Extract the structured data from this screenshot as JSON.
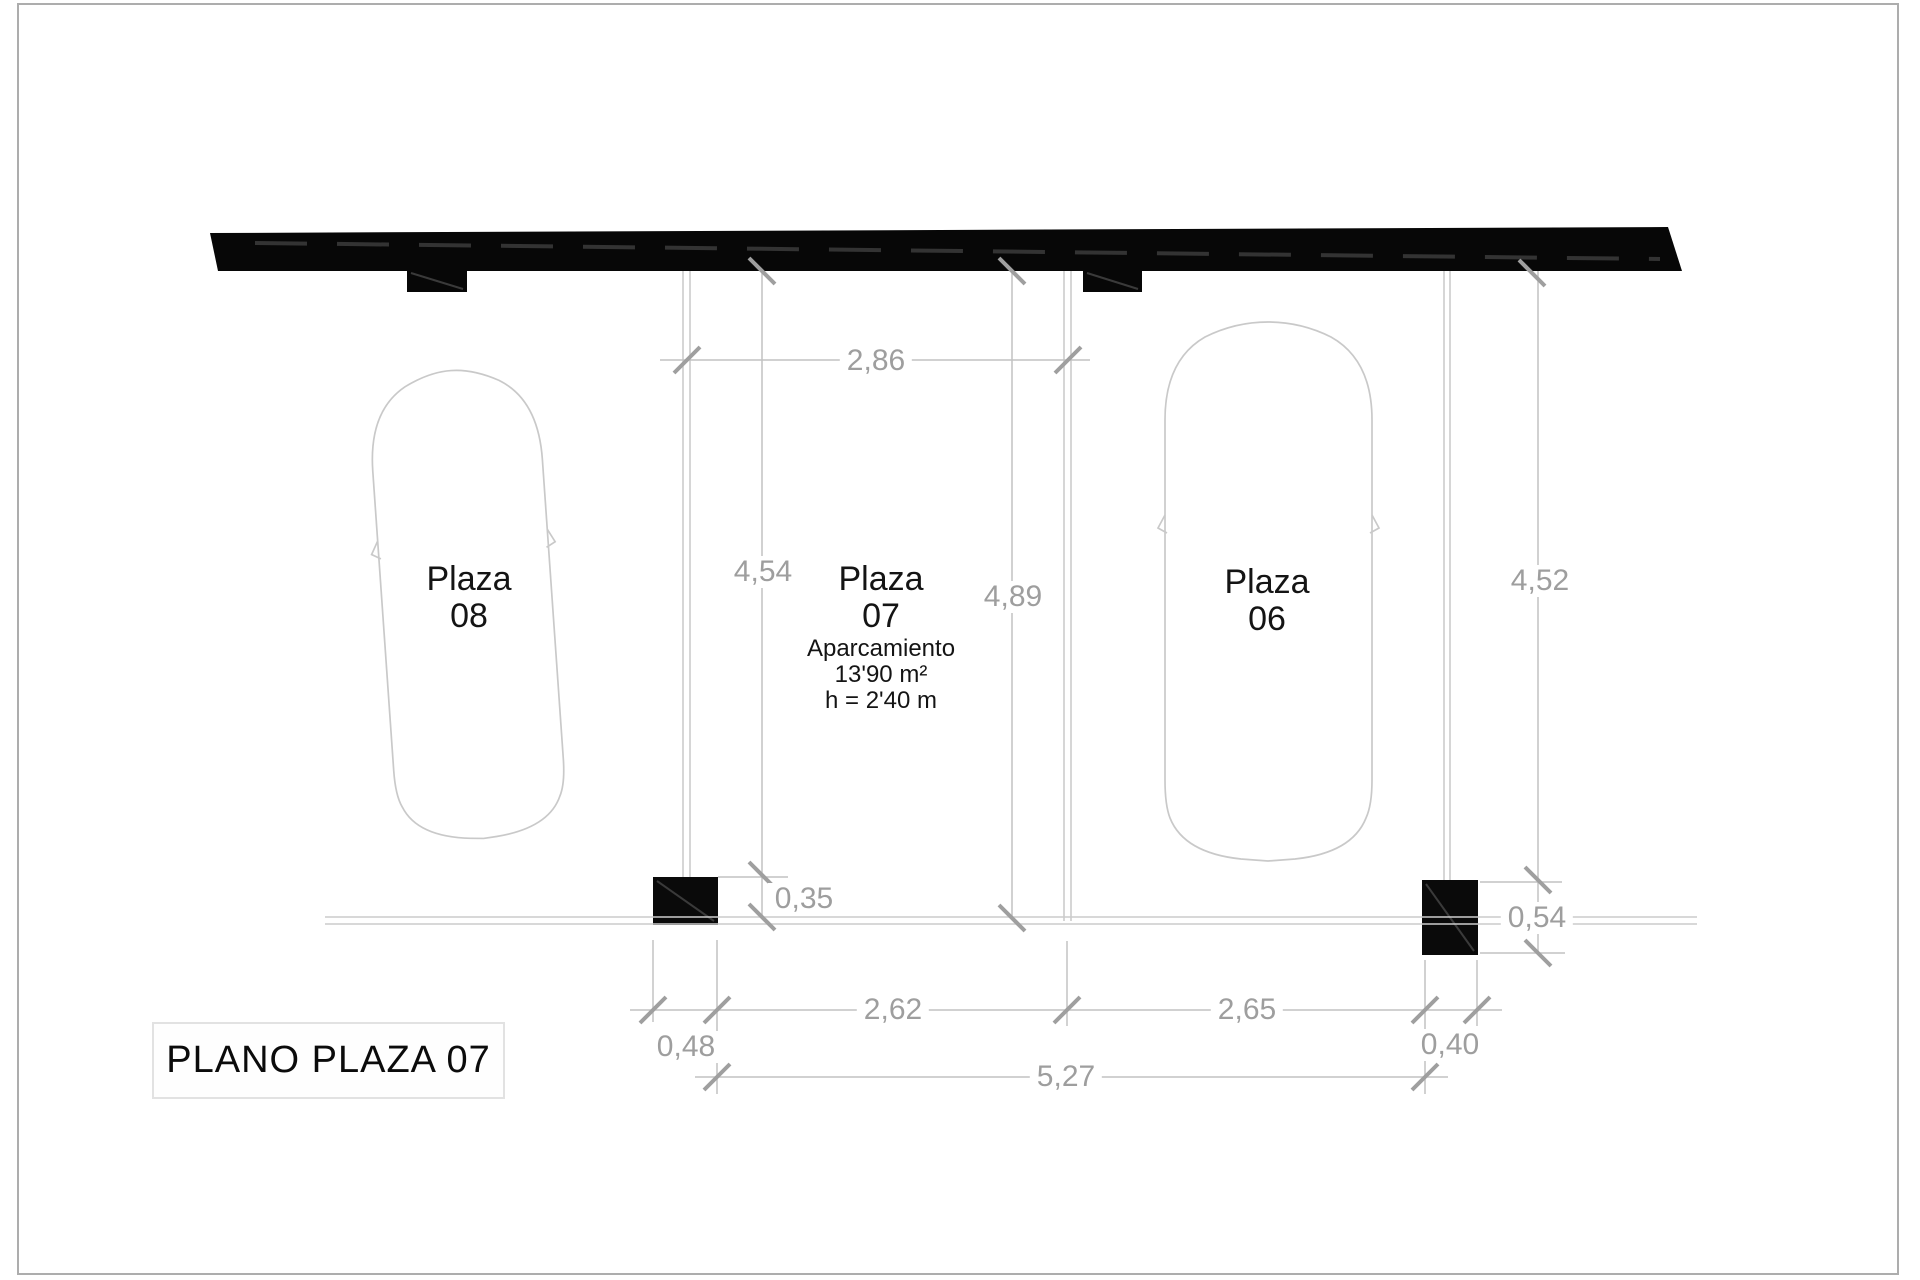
{
  "title_block": {
    "label": "PLANO PLAZA 07"
  },
  "plazas": [
    {
      "name": "Plaza",
      "number": "08"
    },
    {
      "name": "Plaza",
      "number": "07",
      "details": [
        "Aparcamiento",
        "13'90 m²",
        "h = 2'40 m"
      ]
    },
    {
      "name": "Plaza",
      "number": "06"
    }
  ],
  "dimensions": {
    "top_width": "2,86",
    "depth_left": "4,54",
    "depth_center": "4,89",
    "depth_right": "4,52",
    "pillar_left_height": "0,35",
    "pillar_right_height": "0,54",
    "offset_left": "0,48",
    "span_left": "2,62",
    "span_right": "2,65",
    "offset_right": "0,40",
    "total_span": "5,27"
  },
  "colors": {
    "wall": "#070707",
    "dimension_text": "#9e9e9e",
    "drawing_line": "#c6c6c6",
    "ink": "#141414",
    "page_border": "#adadad"
  }
}
